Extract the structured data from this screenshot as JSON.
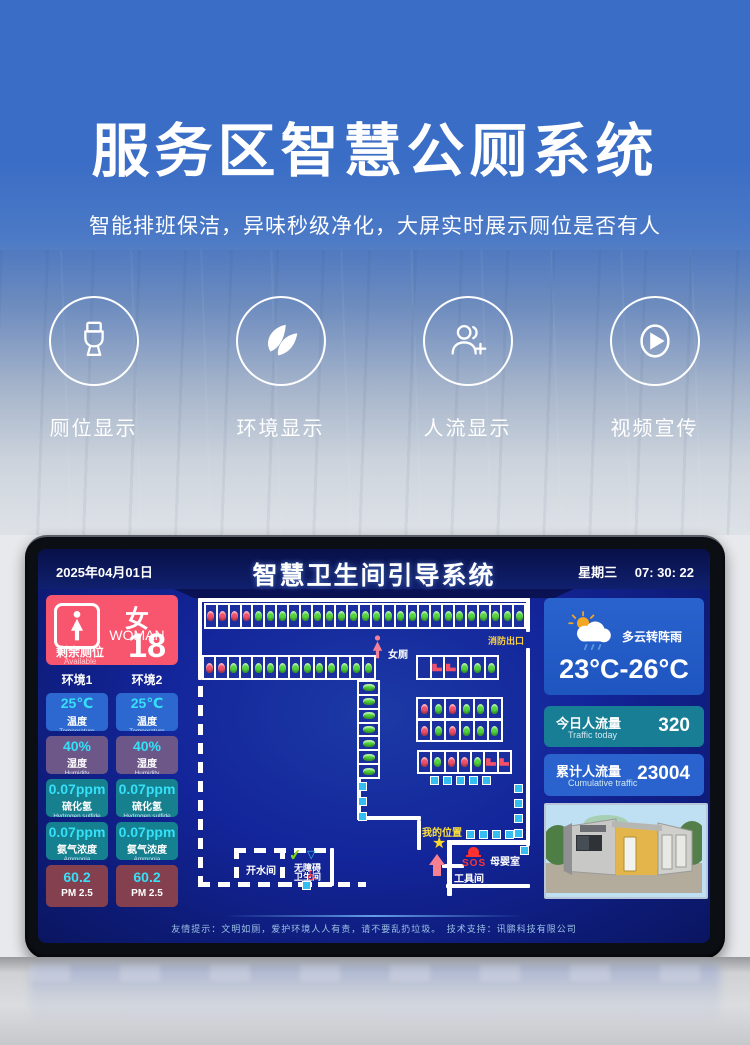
{
  "hero": {
    "title": "服务区智慧公厕系统",
    "subtitle": "智能排班保洁，异味秒级净化，大屏实时展示厕位是否有人",
    "features": [
      {
        "label": "厕位显示",
        "icon": "toilet-icon"
      },
      {
        "label": "环境显示",
        "icon": "leaf-icon"
      },
      {
        "label": "人流显示",
        "icon": "people-icon"
      },
      {
        "label": "视频宣传",
        "icon": "play-icon"
      }
    ]
  },
  "screen": {
    "date": "2025年04月01日",
    "title": "智慧卫生间引导系统",
    "weekday": "星期三",
    "time": "07: 30: 22",
    "women": {
      "gender_cn": "女",
      "gender_en": "WOMAN",
      "available_label": "剩余厕位",
      "available_en": "Available",
      "available_count": "18"
    },
    "env_columns": [
      "环境1",
      "环境2"
    ],
    "env_metrics": [
      {
        "value": "25℃",
        "label": "温度",
        "label_en": "Temperature",
        "color": "#2c68cf"
      },
      {
        "value": "40%",
        "label": "湿度",
        "label_en": "Humidity",
        "color": "#6d5788"
      },
      {
        "value": "0.07ppm",
        "label": "硫化氢",
        "label_en": "Hydrogen sulfide",
        "color": "#17808f"
      },
      {
        "value": "0.07ppm",
        "label": "氨气浓度",
        "label_en": "Ammonia",
        "color": "#15808f"
      },
      {
        "value": "60.2",
        "label": "PM 2.5",
        "label_en": "",
        "color": "#84404e"
      }
    ],
    "map": {
      "legend": {
        "A": "available",
        "O": "occupied",
        "B": "urinal-occupied",
        "E": "empty"
      },
      "colors": {
        "available": "#52d83c",
        "occupied": "#f4506a"
      },
      "rows": [
        {
          "name": "top-stall-row",
          "cells": "OOOOAAAAAAAAAAAAAAAAAAAAAAA"
        },
        {
          "name": "left-stall-row",
          "cells": "OOAAAAAAAAAAAA"
        },
        {
          "name": "vertical-stall-column",
          "cells": "AAAAAAA"
        },
        {
          "name": "squat-row",
          "cells": "EBBAAA"
        },
        {
          "name": "block-row-1",
          "cells": "OAOAAA"
        },
        {
          "name": "block-row-2",
          "cells": "OAOAAA"
        },
        {
          "name": "bottom-stall-row",
          "cells": "OAOOABB"
        }
      ],
      "labels": {
        "fire_exit": "消防出口",
        "women_area": "女厕",
        "my_location": "我的位置",
        "sos": "SOS",
        "nursery": "母婴室",
        "tool_room": "工具间",
        "hot_water": "开水间",
        "accessible_line1": "无障碍",
        "accessible_line2": "卫生间"
      }
    },
    "weather": {
      "desc": "多云转阵雨",
      "temp": "23°C-26°C"
    },
    "traffic_today": {
      "label": "今日人流量",
      "label_en": "Traffic  today",
      "value": "320"
    },
    "traffic_total": {
      "label": "累计人流量",
      "label_en": "Cumulative traffic",
      "value": "23004"
    },
    "footer": "友情提示：文明如厕，爱护环境人人有责，请不要乱扔垃圾。　技术支持：讯鹏科技有限公司"
  }
}
